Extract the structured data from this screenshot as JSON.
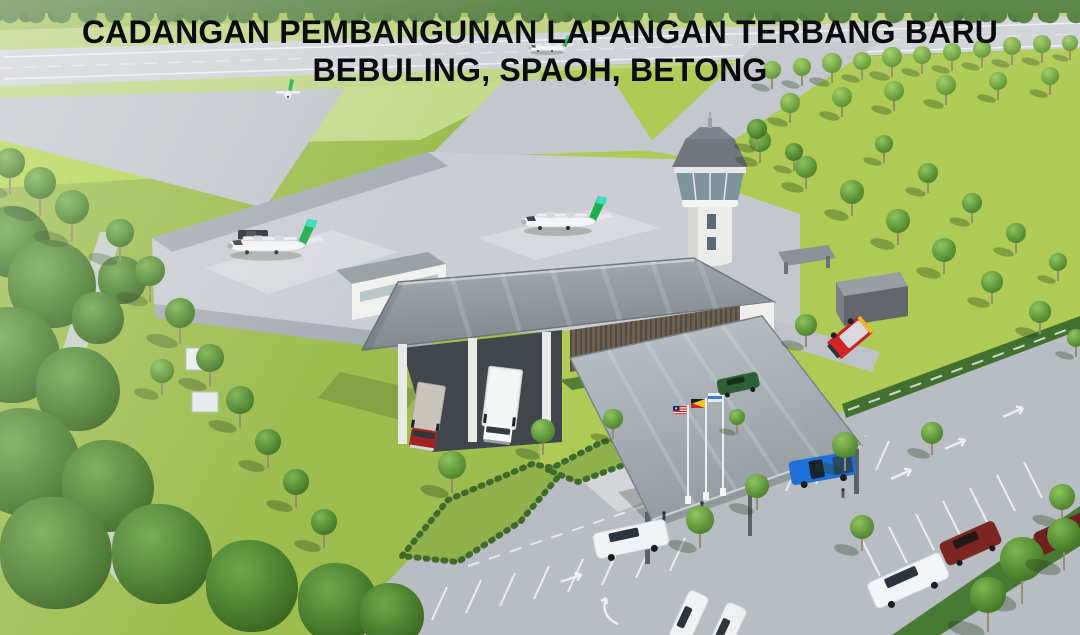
{
  "title": {
    "line1": "CADANGAN PEMBANGUNAN LAPANGAN TERBANG BARU",
    "line2": "BEBULING, SPAOH, BETONG"
  },
  "scene": {
    "aircraft_count": 4,
    "vehicle_counts": {
      "box_trucks": 2,
      "fire_trucks": 1,
      "cars_and_suvs": 9
    },
    "flag_pole_count": 3,
    "palette": {
      "grass": "#9dbd4f",
      "field": "#b0cc52",
      "foliage": "#47762f",
      "runway": "#ced1d7",
      "apron": "#cacdd3",
      "asphalt": "#b8bcc3",
      "roof_grey": "#8d969c",
      "wall_white": "#f1f1ee",
      "aircraft_tail_green": "#1fae4e",
      "aircraft_tail_teal": "#35dec0",
      "fire_truck_red": "#c92121",
      "pickup_blue": "#1e6fd6",
      "title_text": "#0b0b0b"
    }
  }
}
